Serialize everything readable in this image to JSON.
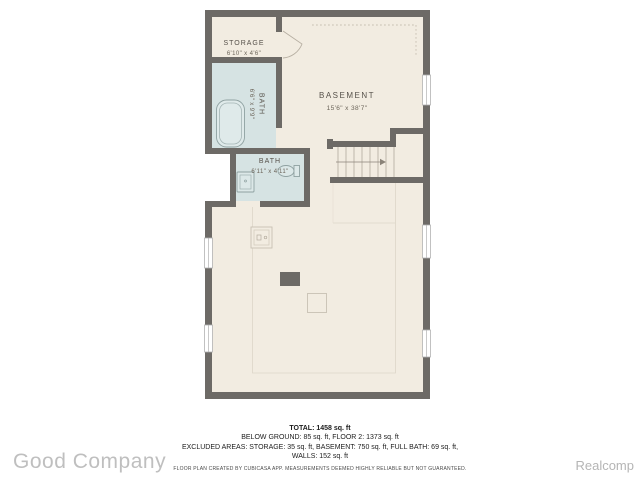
{
  "plan": {
    "rooms": {
      "storage": {
        "label": "STORAGE",
        "dims": "6'10\" x 4'6\""
      },
      "bath_upper": {
        "label": "BATH",
        "dims": "6'6\" x 9'9\""
      },
      "bath_lower": {
        "label": "BATH",
        "dims": "6'11\" x 4'11\""
      },
      "basement": {
        "label": "BASEMENT",
        "dims": "15'6\" x 38'7\""
      }
    },
    "colors": {
      "wall": "#6d6a66",
      "floor": "#f2ece1",
      "bath_floor": "#d6e3e3",
      "fixture_stroke": "#8fa1a1",
      "label_text": "#56514a",
      "dims_text": "#6b6459"
    }
  },
  "summary": {
    "total": "TOTAL: 1458 sq. ft",
    "line2": "BELOW GROUND: 85 sq. ft, FLOOR 2: 1373 sq. ft",
    "line3": "EXCLUDED AREAS: STORAGE: 35 sq. ft, BASEMENT: 750 sq. ft, FULL BATH: 69 sq. ft,",
    "line4": "WALLS: 152 sq. ft",
    "disclaimer": "FLOOR PLAN CREATED BY CUBICASA APP. MEASUREMENTS DEEMED HIGHLY RELIABLE BUT NOT GUARANTEED."
  },
  "watermarks": {
    "left": "Good Company",
    "right": "Realcomp"
  }
}
